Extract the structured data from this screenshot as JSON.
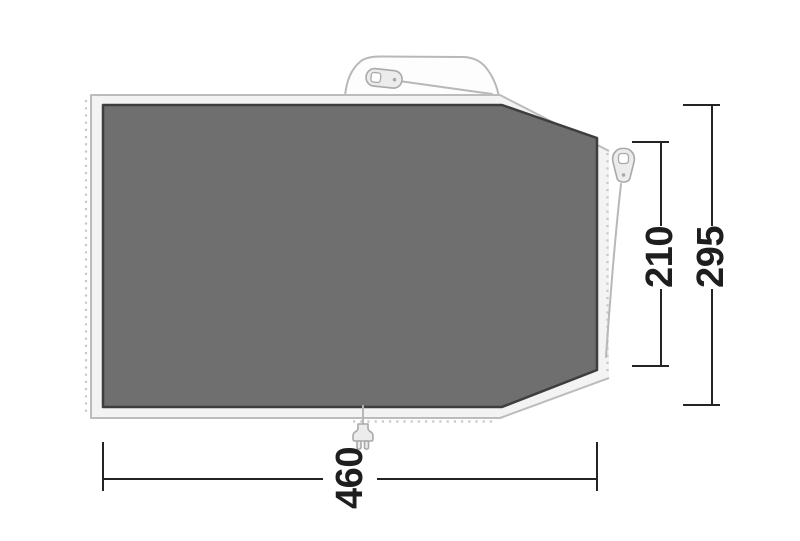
{
  "footprint_diagram": {
    "dimension_labels": {
      "width": "460",
      "right_inner_height": "210",
      "right_outer_height": "295"
    },
    "colors": {
      "background": "#ffffff",
      "floor_fill": "#6f6f6f",
      "floor_outline": "#3e3e3e",
      "groundsheet_fill": "#f3f3f3",
      "groundsheet_outline": "#bcbcbc",
      "accessory_fill": "#ececec",
      "accessory_outline": "#a9a9a9",
      "dotted_line": "#c8c8c8",
      "dimension_line": "#242424",
      "dimension_text": "#1e1e1e"
    },
    "icons": [
      "carry-handle-icon",
      "zipper-pull-icon",
      "power-plug-icon"
    ]
  }
}
